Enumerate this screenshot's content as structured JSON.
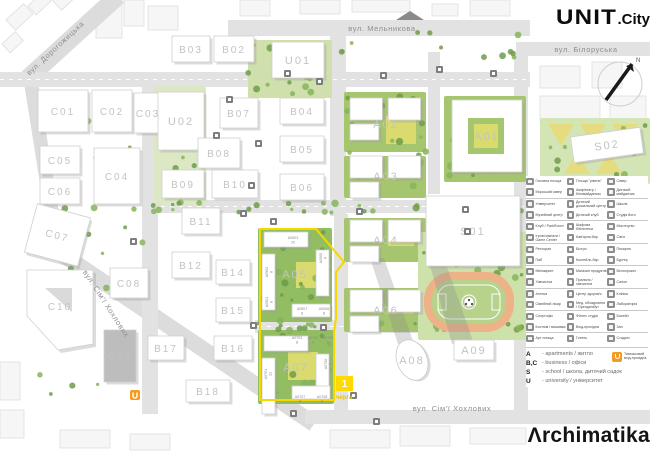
{
  "branding": {
    "logo_unit": "UNIT",
    "logo_unit_suffix": ".City",
    "logo_archimatika": "Λrchimatika"
  },
  "compass": {
    "north_label": "N"
  },
  "streets": [
    {
      "name": "вул. Дорогожицька",
      "x": 57,
      "y": 50,
      "rot": -43
    },
    {
      "name": "вул. Мельникова",
      "x": 382,
      "y": 31,
      "rot": 0
    },
    {
      "name": "вул. Білоруська",
      "x": 586,
      "y": 52,
      "rot": 0
    },
    {
      "name": "вул. Сім'ї Хохлових",
      "x": 104,
      "y": 305,
      "rot": 57
    },
    {
      "name": "вул. Сім'ї Хохлових",
      "x": 452,
      "y": 411,
      "rot": 0
    }
  ],
  "map": {
    "buildings": [
      {
        "label": "C01",
        "x": 38,
        "y": 90,
        "w": 50,
        "h": 42
      },
      {
        "label": "C02",
        "x": 92,
        "y": 90,
        "w": 40,
        "h": 42
      },
      {
        "label": "C03",
        "x": 134,
        "y": 93,
        "w": 28,
        "h": 40
      },
      {
        "label": "C05",
        "x": 40,
        "y": 146,
        "w": 40,
        "h": 28
      },
      {
        "label": "C06",
        "x": 40,
        "y": 178,
        "w": 40,
        "h": 26
      },
      {
        "label": "C04",
        "x": 94,
        "y": 148,
        "w": 46,
        "h": 56
      },
      {
        "label": "C07",
        "x": 30,
        "y": 210,
        "w": 55,
        "h": 50,
        "rot": 15
      },
      {
        "label": "C08",
        "x": 110,
        "y": 268,
        "w": 38,
        "h": 30
      },
      {
        "label": "C09",
        "x": 104,
        "y": 330,
        "w": 32,
        "h": 52,
        "fill": "#bdbdbd"
      },
      {
        "label": "C10",
        "x": 25,
        "y": 268,
        "w": 70,
        "h": 76,
        "shape": "pentagon"
      },
      {
        "label": "B03",
        "x": 172,
        "y": 36,
        "w": 38,
        "h": 26
      },
      {
        "label": "B02",
        "x": 214,
        "y": 36,
        "w": 40,
        "h": 26
      },
      {
        "label": "U01",
        "x": 272,
        "y": 42,
        "w": 52,
        "h": 36
      },
      {
        "label": "U02",
        "x": 158,
        "y": 92,
        "w": 46,
        "h": 58
      },
      {
        "label": "B07",
        "x": 220,
        "y": 98,
        "w": 38,
        "h": 30
      },
      {
        "label": "B04",
        "x": 280,
        "y": 98,
        "w": 44,
        "h": 26
      },
      {
        "label": "B08",
        "x": 198,
        "y": 138,
        "w": 42,
        "h": 30
      },
      {
        "label": "B05",
        "x": 280,
        "y": 136,
        "w": 44,
        "h": 26
      },
      {
        "label": "B09",
        "x": 162,
        "y": 170,
        "w": 42,
        "h": 28
      },
      {
        "label": "B10",
        "x": 212,
        "y": 170,
        "w": 46,
        "h": 28
      },
      {
        "label": "B06",
        "x": 280,
        "y": 174,
        "w": 44,
        "h": 26
      },
      {
        "label": "B11",
        "x": 182,
        "y": 208,
        "w": 38,
        "h": 26
      },
      {
        "label": "B12",
        "x": 172,
        "y": 252,
        "w": 38,
        "h": 26
      },
      {
        "label": "B14",
        "x": 216,
        "y": 260,
        "w": 34,
        "h": 24
      },
      {
        "label": "B15",
        "x": 216,
        "y": 298,
        "w": 34,
        "h": 24
      },
      {
        "label": "B17",
        "x": 148,
        "y": 336,
        "w": 36,
        "h": 24
      },
      {
        "label": "B16",
        "x": 214,
        "y": 336,
        "w": 38,
        "h": 24
      },
      {
        "label": "B18",
        "x": 186,
        "y": 380,
        "w": 44,
        "h": 22
      },
      {
        "label": "A02",
        "x": 350,
        "y": 98,
        "w": 72,
        "h": 52,
        "shape": "cluster"
      },
      {
        "label": "A03",
        "x": 350,
        "y": 156,
        "w": 72,
        "h": 40,
        "shape": "cluster"
      },
      {
        "label": "A04",
        "x": 350,
        "y": 220,
        "w": 72,
        "h": 40,
        "shape": "cluster"
      },
      {
        "label": "A01",
        "x": 452,
        "y": 100,
        "w": 70,
        "h": 72,
        "shape": "court"
      },
      {
        "label": "S02",
        "x": 572,
        "y": 132,
        "w": 70,
        "h": 26,
        "rot": -8
      },
      {
        "label": "A05",
        "x": 258,
        "y": 228,
        "w": 74,
        "h": 92,
        "shape": "block"
      },
      {
        "label": "A06",
        "x": 350,
        "y": 290,
        "w": 72,
        "h": 40,
        "shape": "cluster"
      },
      {
        "label": "A07",
        "x": 258,
        "y": 332,
        "w": 76,
        "h": 70,
        "shape": "block"
      },
      {
        "label": "S01",
        "x": 426,
        "y": 196,
        "w": 94,
        "h": 70
      },
      {
        "label": "A08",
        "x": 397,
        "y": 339,
        "w": 30,
        "h": 42,
        "shape": "ellipse"
      },
      {
        "label": "A09",
        "x": 454,
        "y": 340,
        "w": 40,
        "h": 20
      }
    ],
    "unit_tags": [
      {
        "t": "A0503",
        "n": "20",
        "x": 293,
        "y": 239,
        "rot": 0
      },
      {
        "t": "A0502",
        "n": "8",
        "x": 268,
        "y": 272,
        "rot": -90
      },
      {
        "t": "A0501",
        "n": "8",
        "x": 268,
        "y": 302,
        "rot": -90
      },
      {
        "t": "A0505",
        "n": "8",
        "x": 322,
        "y": 258,
        "rot": -90
      },
      {
        "t": "A0507",
        "n": "8",
        "x": 302,
        "y": 310,
        "rot": 0
      },
      {
        "t": "A0506",
        "n": "8",
        "x": 324,
        "y": 310,
        "rot": 0
      },
      {
        "t": "A0703",
        "n": "8",
        "x": 297,
        "y": 339,
        "rot": 0
      },
      {
        "t": "A0704",
        "n": "8",
        "x": 313,
        "y": 339,
        "rot": 0
      },
      {
        "t": "A0705",
        "n": "8",
        "x": 328,
        "y": 339,
        "rot": 0
      },
      {
        "t": "A0701",
        "n": "22",
        "x": 267,
        "y": 374,
        "rot": -90
      },
      {
        "t": "A0706",
        "n": "7",
        "x": 327,
        "y": 364,
        "rot": -90
      },
      {
        "t": "A0707",
        "n": "8",
        "x": 300,
        "y": 398,
        "rot": 0
      },
      {
        "t": "A0708",
        "n": "8",
        "x": 322,
        "y": 398,
        "rot": 0
      }
    ],
    "phase_badge": {
      "number": "1",
      "label": "черга"
    }
  },
  "legend": {
    "rows": [
      {
        "c": [
          {
            "i": "plaza-icon",
            "t": "Головна площа"
          },
          {
            "i": "terrace-icon",
            "t": "Площа \"рівень\""
          },
          {
            "i": "park-icon",
            "t": "Сквер"
          }
        ]
      },
      {
        "c": [
          {
            "i": "waterfront-icon",
            "t": "Морський сквер"
          },
          {
            "i": "amphitheatre-icon",
            "t": "Амфітеатр / Кіномайданчик"
          },
          {
            "i": "playground-icon",
            "t": "Дитячий майданчик"
          }
        ]
      },
      {
        "c": [
          {
            "i": "university-icon",
            "t": "Університет"
          },
          {
            "i": "kindergarten-icon",
            "t": "Дитячий дошкільний центр"
          },
          {
            "i": "school-icon",
            "t": "Школа"
          }
        ]
      },
      {
        "c": [
          {
            "i": "museum-icon",
            "t": "Музейний центр"
          },
          {
            "i": "kids-club-icon",
            "t": "Дитячий клуб"
          },
          {
            "i": "yoga-icon",
            "t": "Студія йоги"
          }
        ]
      },
      {
        "c": [
          {
            "i": "club-icon",
            "t": "Клуб / ParkRoom"
          },
          {
            "i": "library-icon",
            "t": "Шафова бібліотека"
          },
          {
            "i": "art-icon",
            "t": "Мистецтво"
          }
        ]
      },
      {
        "c": [
          {
            "i": "game-center-icon",
            "t": "Ігрові кімнати / Game Center"
          },
          {
            "i": "coffee-bar-icon",
            "t": "Кав'ярня-бар"
          },
          {
            "i": "family-icon",
            "t": "Сім'я"
          }
        ]
      },
      {
        "c": [
          {
            "i": "restaurant-icon",
            "t": "Ресторан"
          },
          {
            "i": "bistro-icon",
            "t": "Бістро"
          },
          {
            "i": "bakery-icon",
            "t": "Пекарня"
          }
        ]
      },
      {
        "c": [
          {
            "i": "pub-icon",
            "t": "Паб"
          },
          {
            "i": "cocktail-bar-icon",
            "t": "Коктейль-бар"
          },
          {
            "i": "burger-icon",
            "t": "Бургер"
          }
        ]
      },
      {
        "c": [
          {
            "i": "minimarket-icon",
            "t": "Мінімаркет"
          },
          {
            "i": "grocery-icon",
            "t": "Магазин продуктів"
          },
          {
            "i": "bike-rental-icon",
            "t": "Велопрокат"
          }
        ]
      },
      {
        "c": [
          {
            "i": "dry-cleaning-icon",
            "t": "Хімчистка"
          },
          {
            "i": "laundry-icon",
            "t": "Пральня / хімчистка"
          },
          {
            "i": "salon-icon",
            "t": "Салон"
          }
        ]
      },
      {
        "c": [
          {
            "i": "pharmacy-icon",
            "t": "Аптека"
          },
          {
            "i": "health-center-icon",
            "t": "Центр здоров'я"
          },
          {
            "i": "clinic-icon",
            "t": "Клініка"
          }
        ]
      },
      {
        "c": [
          {
            "i": "family-doctor-icon",
            "t": "Сімейний лікар"
          },
          {
            "i": "med-equipment-icon",
            "t": "Мед. обладнання / Оренда/збут"
          },
          {
            "i": "laboratory-icon",
            "t": "Лабораторія"
          }
        ]
      },
      {
        "c": [
          {
            "i": "sport-office-icon",
            "t": "Спортофіс"
          },
          {
            "i": "fitness-icon",
            "t": "Фітнес студія"
          },
          {
            "i": "pool-icon",
            "t": "Басейн"
          }
        ]
      },
      {
        "c": [
          {
            "i": "atelier-icon",
            "t": "Костюм / вишивка"
          },
          {
            "i": "entrance-icon",
            "t": "Вхід-прохідна"
          },
          {
            "i": "hall-icon",
            "t": "Зал"
          }
        ]
      },
      {
        "c": [
          {
            "i": "art-square-icon",
            "t": "Арт площа"
          },
          {
            "i": "hotel-icon",
            "t": "Готель"
          },
          {
            "i": "stadium-icon",
            "t": "Стадіон"
          }
        ]
      }
    ],
    "types": [
      {
        "key": "A",
        "val": "- apartments / житло"
      },
      {
        "key": "B,C",
        "val": "- business / офіси"
      },
      {
        "key": "S",
        "val": "- school / школа, дитячий садок"
      },
      {
        "key": "U",
        "val": "- university / університет"
      }
    ],
    "stop": {
      "line1": "Тимчасовий",
      "line2": "вхід-прохідна"
    }
  }
}
